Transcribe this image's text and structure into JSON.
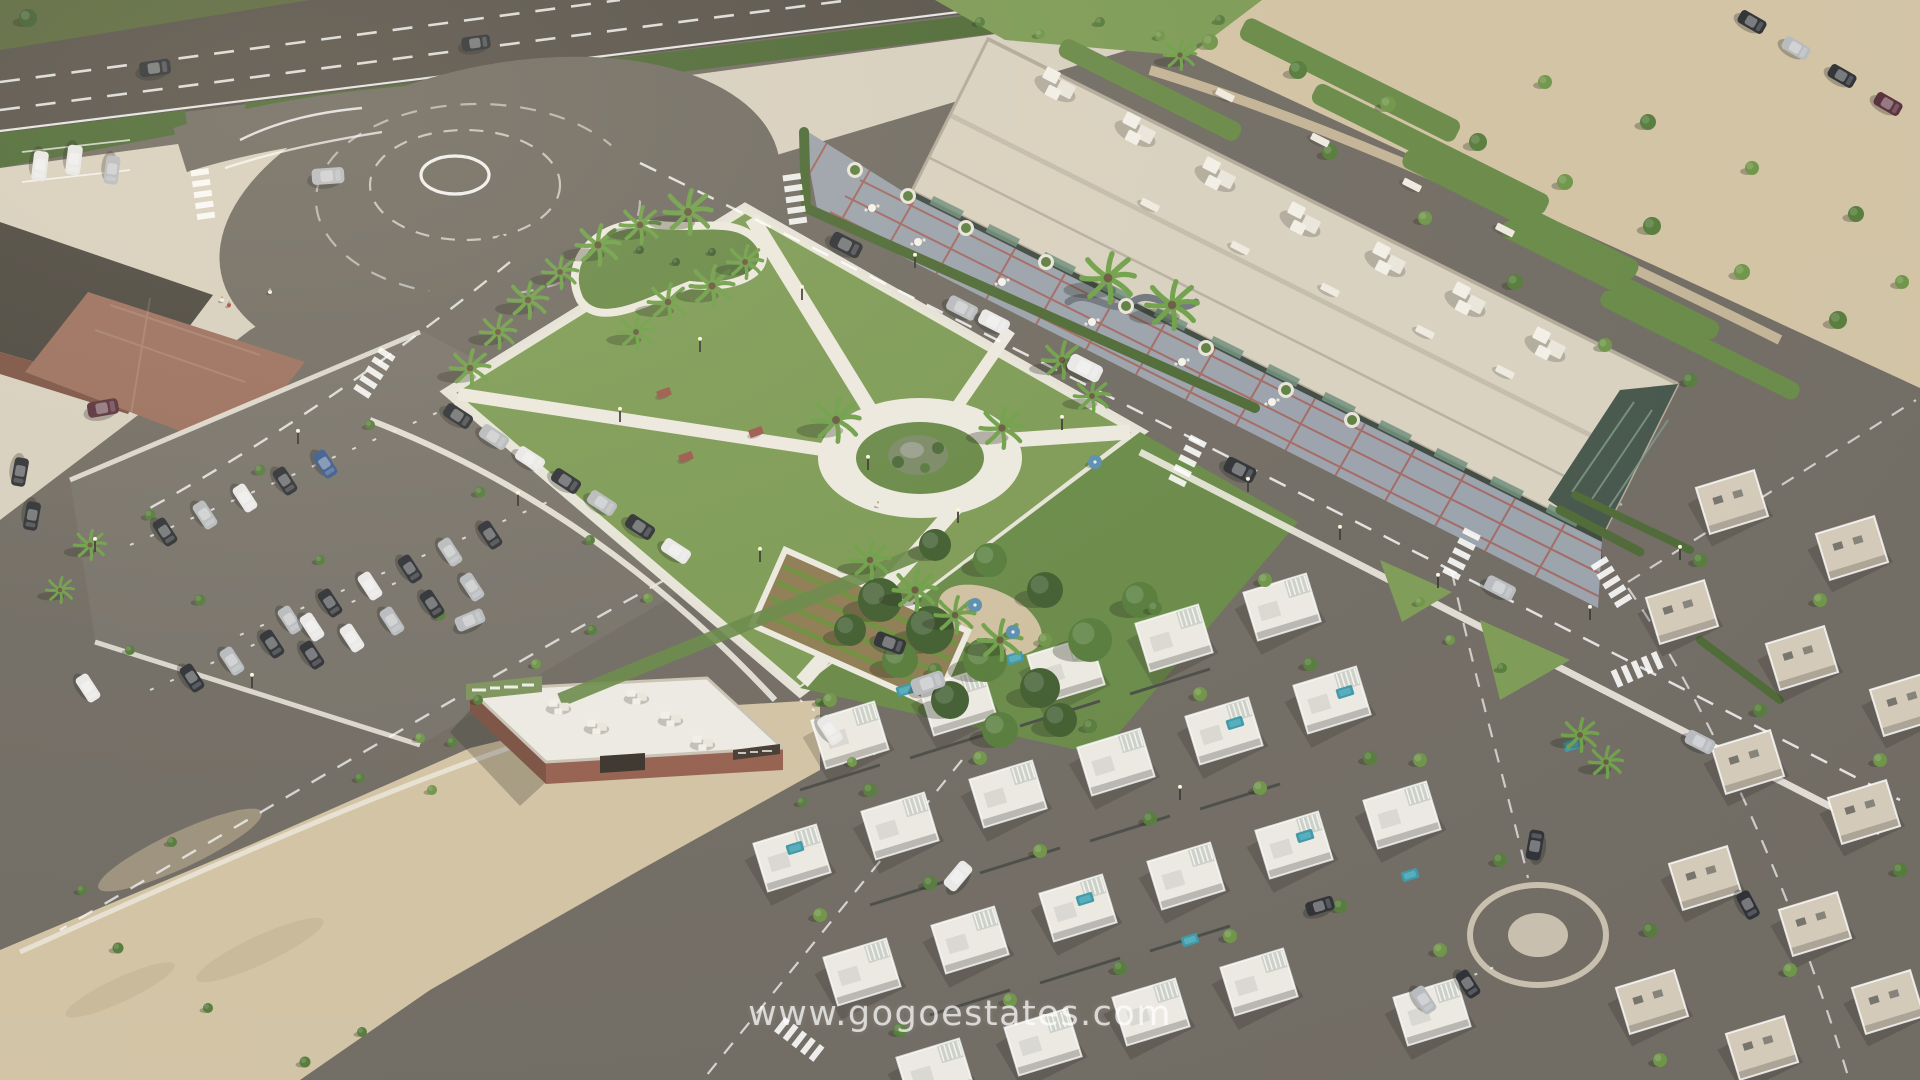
{
  "meta": {
    "type": "aerial-3d-render",
    "description": "Aerial 3D architectural render of a coastal residential development: central public park with palm trees and circular plaza, long commercial building with rooftop units and red-grid terrace, large car parks, sandy vacant lots, and clusters of modern white and beige villas with pools.",
    "camera": "high oblique bird's-eye view, afternoon sun from upper right"
  },
  "watermark": {
    "text": "www.gogoestates.com"
  },
  "colors": {
    "asphalt": "#716c64",
    "highway": "#57524b",
    "beige": "#d8d0c0",
    "sand": "#d2c3a5",
    "path": "#ece9df",
    "grass": "#7d9b56",
    "grassdark": "#698a49",
    "grassdeep": "#5a683f",
    "hedge": "#4e6a37",
    "tree1": "#6f9549",
    "tree2": "#567c3c",
    "tree3": "#415e31",
    "palm": "#6fa04b",
    "tile": "#9aa2ac",
    "tileline": "#a45c52",
    "roofbeige": "#d9d1c0",
    "roofwhite": "#eceae3",
    "glass": "#3e4a42",
    "brick": "#95604f",
    "brickdark": "#7b5244",
    "villa": "#ebe9e2",
    "beigevilla": "#d4cab9",
    "pool": "#3f98a8",
    "cardark": "#2f3237",
    "carsilver": "#b8bbbf",
    "carwhite": "#e9e9e9",
    "carblue": "#3d5c8f",
    "carmaroon": "#59313d"
  },
  "scene": {
    "palms": [
      [
        470,
        368,
        1.0
      ],
      [
        498,
        332,
        0.9
      ],
      [
        528,
        300,
        1.0
      ],
      [
        560,
        272,
        0.9
      ],
      [
        598,
        245,
        1.1
      ],
      [
        640,
        225,
        1.0
      ],
      [
        688,
        212,
        1.2
      ],
      [
        636,
        332,
        0.9
      ],
      [
        668,
        302,
        1.0
      ],
      [
        712,
        286,
        1.1
      ],
      [
        745,
        262,
        0.9
      ],
      [
        836,
        420,
        1.2
      ],
      [
        1002,
        428,
        1.1
      ],
      [
        1062,
        360,
        1.0
      ],
      [
        1092,
        396,
        0.9
      ],
      [
        870,
        560,
        1.0
      ],
      [
        915,
        590,
        1.1
      ],
      [
        955,
        615,
        1.0
      ],
      [
        1000,
        640,
        1.1
      ],
      [
        1108,
        278,
        1.35
      ],
      [
        1172,
        305,
        1.3
      ],
      [
        1580,
        735,
        0.9
      ],
      [
        1606,
        762,
        0.85
      ],
      [
        90,
        545,
        0.8
      ],
      [
        60,
        590,
        0.7
      ],
      [
        1180,
        55,
        0.8
      ]
    ],
    "trees": [
      [
        1210,
        42,
        0.8,
        1
      ],
      [
        1298,
        70,
        0.9,
        2
      ],
      [
        1388,
        104,
        0.8,
        1
      ],
      [
        1478,
        142,
        0.9,
        2
      ],
      [
        1565,
        182,
        0.8,
        1
      ],
      [
        1652,
        226,
        0.9,
        2
      ],
      [
        1742,
        272,
        0.8,
        1
      ],
      [
        1838,
        320,
        0.9,
        2
      ],
      [
        1545,
        82,
        0.7,
        1
      ],
      [
        1648,
        122,
        0.8,
        2
      ],
      [
        1752,
        168,
        0.7,
        1
      ],
      [
        1856,
        214,
        0.8,
        2
      ],
      [
        1902,
        282,
        0.7,
        1
      ],
      [
        1330,
        152,
        0.8,
        2
      ],
      [
        1425,
        218,
        0.7,
        1
      ],
      [
        1515,
        282,
        0.8,
        2
      ],
      [
        1605,
        345,
        0.7,
        1
      ],
      [
        1690,
        380,
        0.7,
        2
      ],
      [
        980,
        22,
        0.5,
        2
      ],
      [
        1040,
        34,
        0.5,
        1
      ],
      [
        1100,
        22,
        0.5,
        2
      ],
      [
        1160,
        36,
        0.5,
        1
      ],
      [
        1220,
        20,
        0.5,
        2
      ],
      [
        28,
        18,
        0.9,
        3
      ],
      [
        150,
        515,
        0.55,
        2
      ],
      [
        260,
        470,
        0.55,
        2
      ],
      [
        370,
        425,
        0.5,
        2
      ],
      [
        480,
        492,
        0.55,
        2
      ],
      [
        590,
        540,
        0.5,
        2
      ],
      [
        200,
        600,
        0.55,
        2
      ],
      [
        320,
        560,
        0.5,
        2
      ],
      [
        440,
        615,
        0.55,
        2
      ],
      [
        130,
        650,
        0.5,
        2
      ],
      [
        118,
        948,
        0.55,
        2
      ],
      [
        208,
        1008,
        0.5,
        2
      ],
      [
        305,
        1062,
        0.55,
        2
      ],
      [
        362,
        1032,
        0.5,
        2
      ],
      [
        172,
        842,
        0.5,
        2
      ],
      [
        82,
        890,
        0.5,
        2
      ],
      [
        648,
        598,
        0.5,
        1
      ],
      [
        592,
        630,
        0.5,
        2
      ],
      [
        536,
        664,
        0.5,
        1
      ],
      [
        478,
        700,
        0.5,
        2
      ],
      [
        420,
        738,
        0.5,
        1
      ],
      [
        360,
        778,
        0.5,
        2
      ],
      [
        1450,
        640,
        0.5,
        1
      ],
      [
        1502,
        668,
        0.5,
        2
      ],
      [
        1420,
        602,
        0.5,
        1
      ],
      [
        452,
        742,
        0.5,
        2
      ],
      [
        432,
        790,
        0.5,
        1
      ],
      [
        820,
        702,
        0.5,
        2
      ],
      [
        852,
        762,
        0.5,
        1
      ],
      [
        802,
        802,
        0.5,
        2
      ],
      [
        880,
        600,
        2.2,
        3
      ],
      [
        930,
        630,
        2.4,
        3
      ],
      [
        985,
        660,
        2.2,
        2
      ],
      [
        1040,
        688,
        2.0,
        3
      ],
      [
        1090,
        640,
        2.2,
        2
      ],
      [
        1045,
        590,
        1.8,
        3
      ],
      [
        990,
        560,
        1.7,
        2
      ],
      [
        935,
        545,
        1.6,
        3
      ],
      [
        1140,
        600,
        1.8,
        2
      ],
      [
        950,
        700,
        1.9,
        3
      ],
      [
        1000,
        730,
        1.8,
        2
      ],
      [
        1060,
        720,
        1.7,
        3
      ],
      [
        900,
        660,
        1.8,
        2
      ],
      [
        850,
        630,
        1.6,
        3
      ],
      [
        640,
        250,
        0.4,
        3
      ],
      [
        676,
        262,
        0.4,
        3
      ],
      [
        712,
        252,
        0.4,
        3
      ],
      [
        830,
        700,
        0.7,
        1
      ],
      [
        935,
        670,
        0.7,
        2
      ],
      [
        1045,
        640,
        0.7,
        1
      ],
      [
        1155,
        608,
        0.7,
        2
      ],
      [
        1265,
        580,
        0.7,
        1
      ],
      [
        870,
        790,
        0.7,
        2
      ],
      [
        980,
        758,
        0.7,
        1
      ],
      [
        1090,
        726,
        0.7,
        2
      ],
      [
        1200,
        694,
        0.7,
        1
      ],
      [
        1310,
        664,
        0.7,
        2
      ],
      [
        820,
        915,
        0.7,
        1
      ],
      [
        930,
        883,
        0.7,
        2
      ],
      [
        1040,
        851,
        0.7,
        1
      ],
      [
        1150,
        819,
        0.7,
        2
      ],
      [
        1260,
        788,
        0.7,
        1
      ],
      [
        1370,
        758,
        0.7,
        2
      ],
      [
        900,
        1030,
        0.7,
        2
      ],
      [
        1010,
        1000,
        0.7,
        1
      ],
      [
        1120,
        968,
        0.7,
        2
      ],
      [
        1230,
        936,
        0.7,
        1
      ],
      [
        1340,
        906,
        0.7,
        2
      ],
      [
        1440,
        950,
        0.7,
        1
      ],
      [
        1500,
        860,
        0.7,
        2
      ],
      [
        1420,
        760,
        0.7,
        1
      ],
      [
        1700,
        560,
        0.7,
        2
      ],
      [
        1820,
        600,
        0.7,
        1
      ],
      [
        1760,
        710,
        0.7,
        2
      ],
      [
        1880,
        760,
        0.7,
        1
      ],
      [
        1650,
        930,
        0.7,
        2
      ],
      [
        1790,
        970,
        0.7,
        1
      ],
      [
        1900,
        870,
        0.7,
        2
      ],
      [
        1660,
        1060,
        0.7,
        1
      ]
    ],
    "cars": [
      [
        155,
        68,
        -8,
        "dark",
        1.2
      ],
      [
        476,
        43,
        -8,
        "dark",
        1.1
      ],
      [
        328,
        176,
        -4,
        "silver",
        1.25
      ],
      [
        846,
        245,
        27,
        "dark",
        1.25
      ],
      [
        962,
        308,
        27,
        "silver",
        1.2
      ],
      [
        994,
        322,
        27,
        "white",
        1.2
      ],
      [
        1085,
        368,
        27,
        "white",
        1.35
      ],
      [
        1240,
        470,
        27,
        "dark",
        1.25
      ],
      [
        1500,
        588,
        27,
        "silver",
        1.2
      ],
      [
        458,
        416,
        33,
        "dark",
        1.15
      ],
      [
        494,
        437,
        33,
        "silver",
        1.15
      ],
      [
        530,
        459,
        33,
        "white",
        1.15
      ],
      [
        566,
        481,
        33,
        "dark",
        1.15
      ],
      [
        602,
        503,
        33,
        "silver",
        1.15
      ],
      [
        640,
        527,
        33,
        "dark",
        1.15
      ],
      [
        676,
        551,
        33,
        "white",
        1.15
      ],
      [
        890,
        643,
        20,
        "dark",
        1.2
      ],
      [
        928,
        683,
        -19,
        "silver",
        1.3
      ],
      [
        958,
        876,
        -50,
        "white",
        1.2
      ],
      [
        165,
        532,
        57,
        "dark",
        1.1
      ],
      [
        205,
        515,
        57,
        "silver",
        1.1
      ],
      [
        245,
        498,
        57,
        "white",
        1.1
      ],
      [
        285,
        481,
        57,
        "dark",
        1.1
      ],
      [
        325,
        464,
        57,
        "blue",
        1.1
      ],
      [
        290,
        620,
        57,
        "silver",
        1.1
      ],
      [
        330,
        603,
        57,
        "dark",
        1.1
      ],
      [
        370,
        586,
        57,
        "white",
        1.1
      ],
      [
        410,
        569,
        57,
        "dark",
        1.1
      ],
      [
        450,
        552,
        57,
        "silver",
        1.1
      ],
      [
        490,
        535,
        57,
        "dark",
        1.1
      ],
      [
        312,
        655,
        57,
        "dark",
        1.1
      ],
      [
        352,
        638,
        57,
        "white",
        1.1
      ],
      [
        392,
        621,
        57,
        "silver",
        1.1
      ],
      [
        432,
        604,
        57,
        "dark",
        1.1
      ],
      [
        472,
        587,
        57,
        "silver",
        1.1
      ],
      [
        192,
        678,
        57,
        "dark",
        1.1
      ],
      [
        232,
        661,
        57,
        "silver",
        1.1
      ],
      [
        272,
        644,
        57,
        "dark",
        1.1
      ],
      [
        312,
        627,
        57,
        "white",
        1.1
      ],
      [
        470,
        620,
        -23,
        "silver",
        1.15
      ],
      [
        88,
        688,
        57,
        "white",
        1.1
      ],
      [
        103,
        408,
        -10,
        "maroon",
        1.2
      ],
      [
        20,
        472,
        100,
        "dark",
        1.1
      ],
      [
        32,
        516,
        100,
        "dark",
        1.1
      ],
      [
        40,
        166,
        97,
        "white",
        1.15
      ],
      [
        74,
        160,
        97,
        "white",
        1.15
      ],
      [
        112,
        170,
        97,
        "silver",
        1.1
      ],
      [
        1752,
        22,
        30,
        "dark",
        1.1
      ],
      [
        1796,
        48,
        30,
        "silver",
        1.1
      ],
      [
        1842,
        76,
        30,
        "dark",
        1.1
      ],
      [
        1888,
        104,
        30,
        "maroon",
        1.1
      ],
      [
        1535,
        845,
        -80,
        "dark",
        1.15
      ],
      [
        1424,
        1000,
        57,
        "silver",
        1.1
      ],
      [
        1468,
        984,
        57,
        "dark",
        1.1
      ],
      [
        1320,
        906,
        -17,
        "dark",
        1.1
      ],
      [
        1748,
        905,
        62,
        "dark",
        1.1
      ],
      [
        1700,
        742,
        27,
        "silver",
        1.15
      ],
      [
        830,
        730,
        57,
        "white",
        1.15
      ]
    ],
    "villas_white": [
      [
        850,
        735
      ],
      [
        958,
        702
      ],
      [
        1066,
        670
      ],
      [
        1174,
        638
      ],
      [
        1282,
        607
      ],
      [
        792,
        858
      ],
      [
        900,
        826
      ],
      [
        1008,
        794
      ],
      [
        1116,
        762
      ],
      [
        1224,
        731
      ],
      [
        1332,
        700
      ],
      [
        862,
        972
      ],
      [
        970,
        940
      ],
      [
        1078,
        908
      ],
      [
        1186,
        876
      ],
      [
        1294,
        845
      ],
      [
        1402,
        815
      ],
      [
        935,
        1072
      ],
      [
        1043,
        1042
      ],
      [
        1151,
        1012
      ],
      [
        1259,
        982
      ],
      [
        1432,
        1012
      ]
    ],
    "villas_beige": [
      [
        1732,
        502
      ],
      [
        1852,
        548
      ],
      [
        1682,
        612
      ],
      [
        1802,
        658
      ],
      [
        1906,
        704
      ],
      [
        1748,
        762
      ],
      [
        1864,
        812
      ],
      [
        1705,
        878
      ],
      [
        1815,
        924
      ],
      [
        1652,
        1002
      ],
      [
        1762,
        1048
      ],
      [
        1888,
        1002
      ]
    ],
    "pools": [
      [
        905,
        690
      ],
      [
        1015,
        658
      ],
      [
        1235,
        723
      ],
      [
        1345,
        692
      ],
      [
        795,
        848
      ],
      [
        1085,
        899
      ],
      [
        1305,
        836
      ],
      [
        1572,
        745
      ],
      [
        1190,
        940
      ],
      [
        1410,
        875
      ]
    ],
    "hvac": [
      [
        1060,
        85
      ],
      [
        1140,
        130
      ],
      [
        1220,
        175
      ],
      [
        1305,
        220
      ],
      [
        1390,
        260
      ],
      [
        1470,
        300
      ],
      [
        1550,
        345
      ]
    ],
    "ff_hvac": [
      [
        560,
        706
      ],
      [
        598,
        726
      ],
      [
        638,
        696
      ],
      [
        672,
        718
      ],
      [
        704,
        742
      ]
    ],
    "benches": [
      [
        1150,
        205,
        27
      ],
      [
        1240,
        248,
        27
      ],
      [
        1330,
        290,
        27
      ],
      [
        1425,
        332,
        27
      ],
      [
        1505,
        372,
        27
      ],
      [
        1225,
        95,
        27
      ],
      [
        1320,
        140,
        27
      ],
      [
        1412,
        185,
        27
      ],
      [
        1505,
        230,
        27
      ]
    ],
    "tables": [
      [
        872,
        208
      ],
      [
        918,
        242
      ],
      [
        1002,
        282
      ],
      [
        1092,
        322
      ],
      [
        1182,
        362
      ],
      [
        1272,
        402
      ]
    ],
    "planters": [
      [
        855,
        170
      ],
      [
        908,
        196
      ],
      [
        966,
        228
      ],
      [
        1046,
        262
      ],
      [
        1126,
        306
      ],
      [
        1206,
        348
      ],
      [
        1286,
        390
      ],
      [
        1352,
        420
      ]
    ],
    "picnic_tables": [
      [
        664,
        393
      ],
      [
        686,
        457
      ],
      [
        756,
        432
      ]
    ],
    "umbrellas": [
      [
        975,
        605
      ],
      [
        1013,
        632
      ],
      [
        1095,
        462
      ]
    ],
    "lamps": [
      [
        700,
        352
      ],
      [
        802,
        300
      ],
      [
        868,
        470
      ],
      [
        958,
        523
      ],
      [
        1062,
        430
      ],
      [
        760,
        562
      ],
      [
        620,
        422
      ],
      [
        915,
        268
      ],
      [
        95,
        552
      ],
      [
        298,
        444
      ],
      [
        518,
        506
      ],
      [
        252,
        688
      ],
      [
        1248,
        492
      ],
      [
        1340,
        540
      ],
      [
        1438,
        588
      ],
      [
        1180,
        800
      ],
      [
        1590,
        620
      ],
      [
        1680,
        560
      ]
    ],
    "zebras": [
      [
        795,
        200,
        82
      ],
      [
        1188,
        460,
        -63
      ],
      [
        1462,
        553,
        -63
      ],
      [
        1612,
        583,
        58
      ],
      [
        1638,
        669,
        -24
      ],
      [
        203,
        195,
        82
      ],
      [
        375,
        372,
        -57
      ],
      [
        800,
        1040,
        38
      ]
    ],
    "people": [
      [
        222,
        300,
        "white"
      ],
      [
        229,
        305,
        "red"
      ],
      [
        270,
        292,
        "white"
      ],
      [
        878,
        505,
        "white"
      ]
    ]
  }
}
